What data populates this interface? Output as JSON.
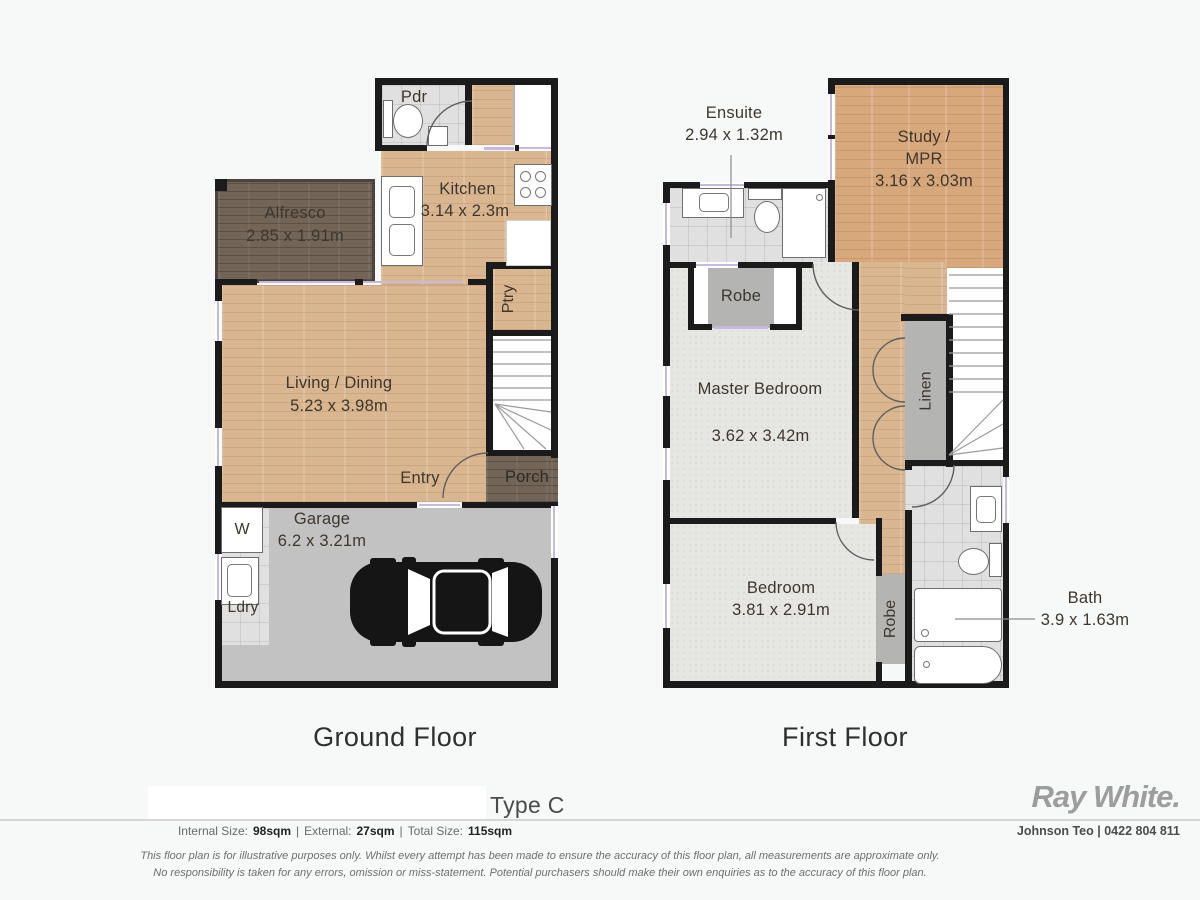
{
  "ground_floor": {
    "title": "Ground Floor",
    "rooms": {
      "pdr": {
        "label": "Pdr"
      },
      "kitchen": {
        "label": "Kitchen",
        "dim": "3.14 x 2.3m"
      },
      "alfresco": {
        "label": "Alfresco",
        "dim": "2.85 x 1.91m"
      },
      "living": {
        "label": "Living / Dining",
        "dim": "5.23 x 3.98m"
      },
      "ptry": {
        "label": "Ptry"
      },
      "entry": {
        "label": "Entry"
      },
      "porch": {
        "label": "Porch"
      },
      "garage": {
        "label": "Garage",
        "dim": "6.2 x 3.21m"
      },
      "washer": {
        "label": "W"
      },
      "ldry": {
        "label": "Ldry"
      }
    }
  },
  "first_floor": {
    "title": "First Floor",
    "rooms": {
      "ensuite": {
        "label": "Ensuite",
        "dim": "2.94 x 1.32m"
      },
      "study": {
        "label": "Study /",
        "label2": "MPR",
        "dim": "3.16 x 3.03m"
      },
      "robe_master": {
        "label": "Robe"
      },
      "master": {
        "label": "Master Bedroom",
        "dim": "3.62 x 3.42m"
      },
      "linen": {
        "label": "Linen"
      },
      "bedroom": {
        "label": "Bedroom",
        "dim": "3.81 x 2.91m"
      },
      "robe_bedroom": {
        "label": "Robe"
      },
      "bath": {
        "label": "Bath",
        "dim": "3.9 x 1.63m"
      }
    }
  },
  "footer": {
    "plan_type": "Type C",
    "sizes": {
      "internal_label": "Internal Size:",
      "internal_value": "98sqm",
      "sep1": "|",
      "external_label": "External:",
      "external_value": "27sqm",
      "sep2": "|",
      "total_label": "Total Size:",
      "total_value": "115sqm"
    },
    "brand": "Ray White.",
    "agent": "Johnson Teo | 0422 804 811",
    "disclaimer1": "This floor plan is for illustrative purposes only. Whilst every attempt has been made to ensure the accuracy of this floor plan, all measurements are approximate only.",
    "disclaimer2": "No responsibility is taken for any errors, omission or miss-statement. Potential purchasers should make their own enquiries as to the accuracy of this floor plan."
  },
  "colors": {
    "wall": "#1b1b1b",
    "window_accent": "#c7b8e2",
    "brand_gray": "#9d9d9d"
  }
}
